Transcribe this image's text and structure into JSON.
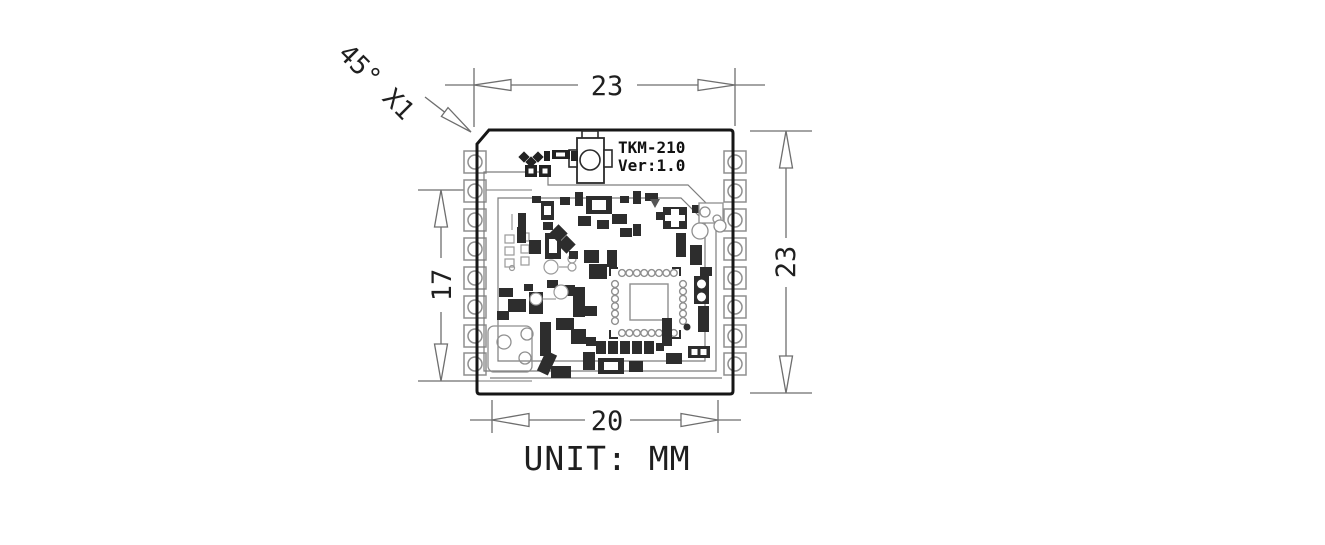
{
  "drawing": {
    "module": {
      "name": "TKM-210",
      "version": "Ver:1.0"
    },
    "dimensions": {
      "top_width": "23",
      "right_height": "23",
      "left_span": "17",
      "bottom_width": "20",
      "chamfer_note": "45° X1"
    },
    "unit_note": "UNIT: MM",
    "colors": {
      "board_outline": "#1a1a1a",
      "dimension_lines": "#6e6e6e",
      "pad_outline": "#8f8f8f",
      "component_ink": "#2d2d2d",
      "text": "#1f1f1f",
      "background": "#ffffff"
    }
  }
}
